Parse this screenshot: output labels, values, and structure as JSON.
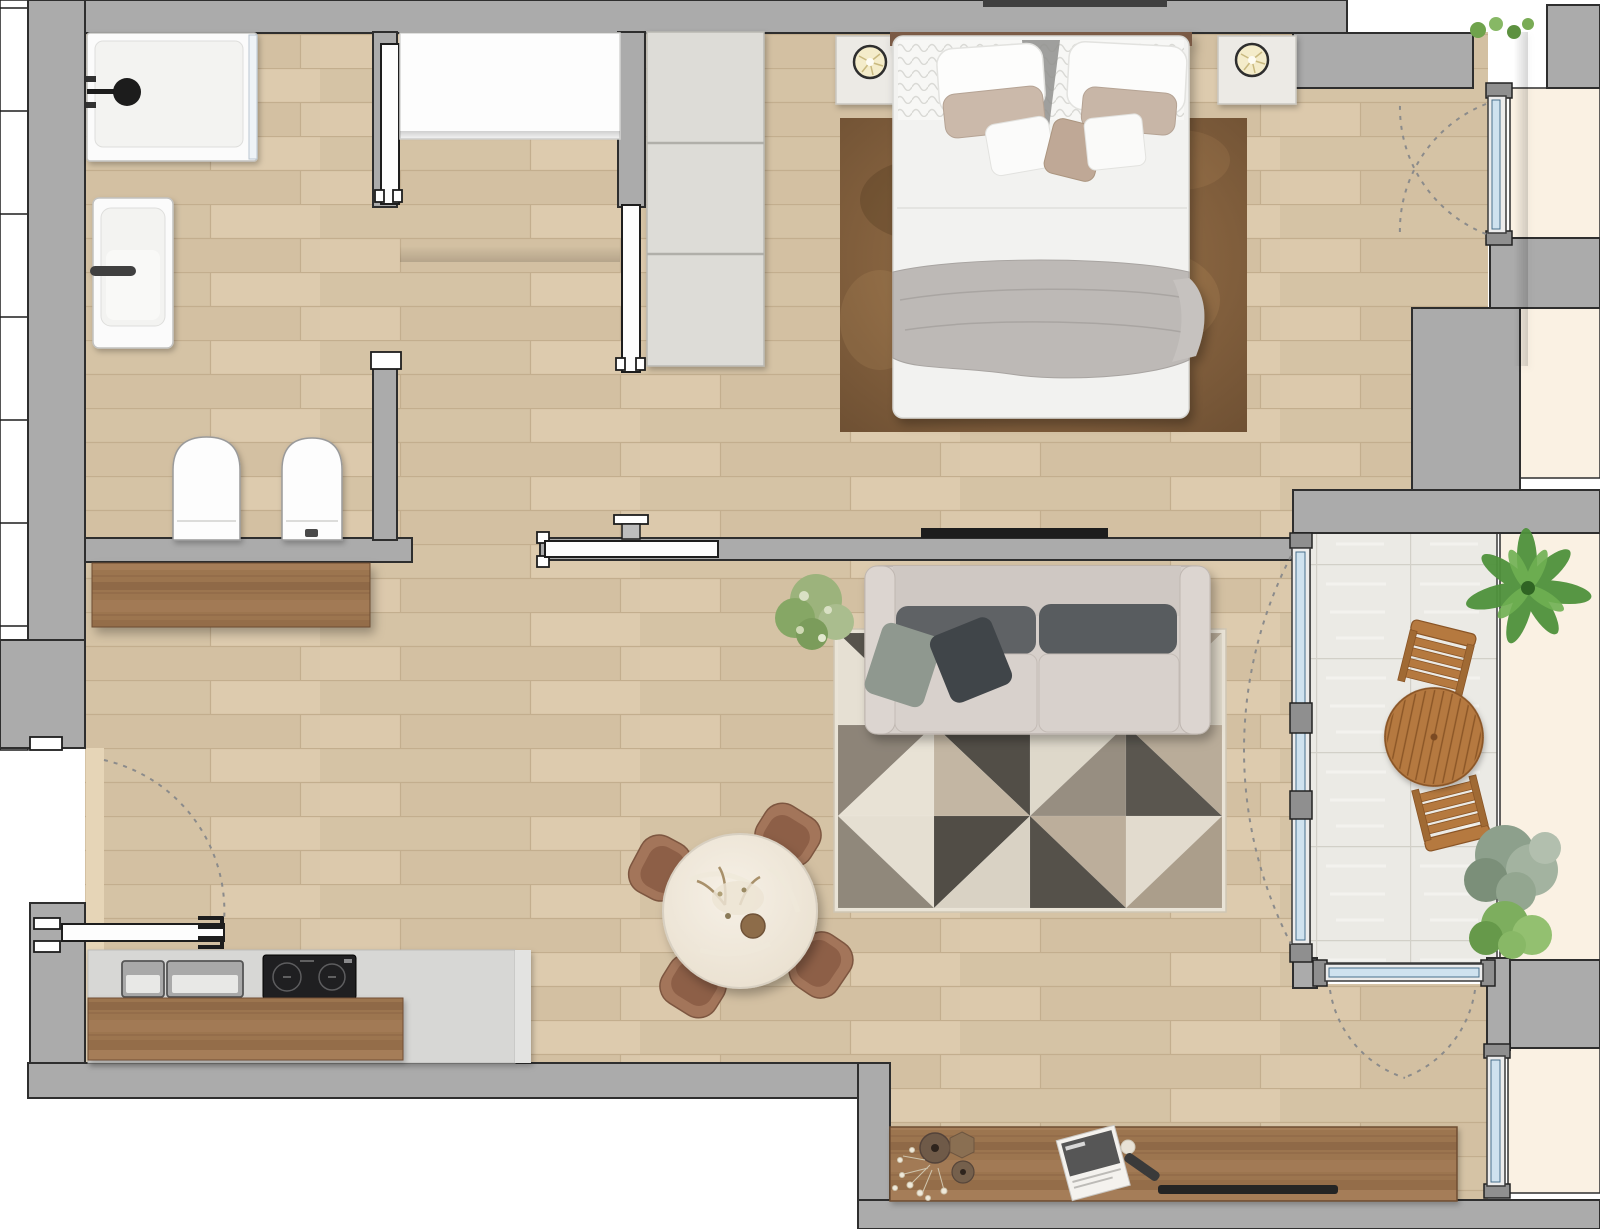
{
  "page": {
    "title": "Apartment floor plan — top-down 2D render",
    "background": "#ffffff"
  },
  "palette": {
    "wall_gray": "#ababab",
    "wall_outline": "#2e2e2e",
    "wood_floor": "#d8c6a9",
    "wood_plank_line": "#c3ae8e",
    "balcony_tile": "#ebeae5",
    "exterior_cream": "#faf1e3",
    "dark_wood_furniture": "#9c7450",
    "bedroom_rug_brown": "#85643f",
    "sofa_greige": "#d6cfca",
    "cushion_charcoal": "#5d6063",
    "bed_white": "#f2f2f0",
    "blanket_gray": "#bdb9b6",
    "glass_blue": "#cfe2ef",
    "outdoor_wood": "#b5793f",
    "plant_green": "#6fa34c"
  },
  "rooms": {
    "bathroom": {
      "label": "Bathroom",
      "furniture": [
        "walk-in shower with black shower head",
        "bathtub with grab bar",
        "toilet",
        "bidet with flush button"
      ]
    },
    "hallway": {
      "label": "Hallway",
      "furniture": [
        "built-in white closet"
      ]
    },
    "bedroom": {
      "label": "Bedroom",
      "furniture": [
        "double bed with white bedding and gray throw blanket",
        "six decorative pillows",
        "two nightstands with round lamps",
        "three-section wardrobe",
        "brown area rug",
        "wall-mounted TV"
      ]
    },
    "living": {
      "label": "Living room with open kitchen",
      "furniture": [
        "three-seat greige sofa with charcoal cushions",
        "geometric triangle rug",
        "round marble dining table",
        "four leather dining chairs",
        "wooden sideboard",
        "media sideboard with vases, magazine, remote and soundbar",
        "green potted plant",
        "kitchen counter with double sink and two-burner cooktop",
        "wooden kitchen island"
      ]
    },
    "balcony": {
      "label": "Balcony",
      "furniture": [
        "round slatted wooden table",
        "two slatted wooden chairs",
        "palm plant",
        "two shrubs"
      ]
    }
  },
  "openings": {
    "entry_door": "hinged entry door at lower left with swing arc",
    "bathroom_door": "sliding pocket door",
    "bedroom_door": "sliding pocket door",
    "living_room_door": "sliding pocket door in hallway wall",
    "bedroom_french_window": "glazed door to exterior, double swing arcs",
    "balcony_glazing": "floor-to-ceiling sliding glass wall",
    "lower_windows": "glazed openings on south and east facade"
  }
}
